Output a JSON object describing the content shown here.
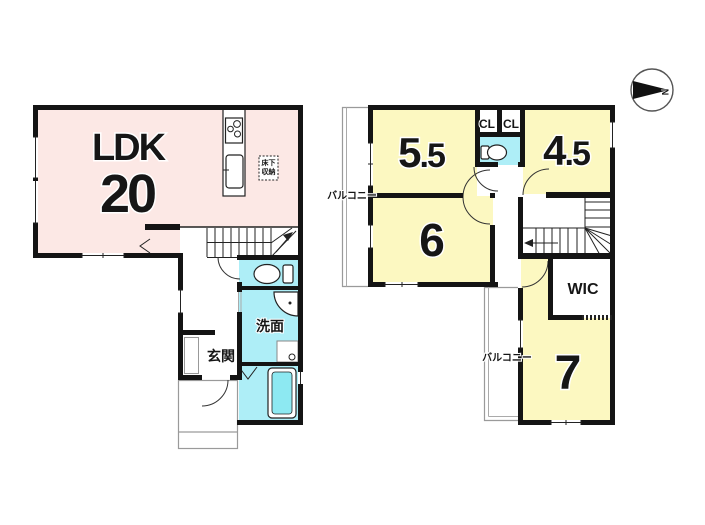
{
  "colors": {
    "wall_color": "#141414",
    "room_pink": "#fce8e5",
    "room_yellow": "#fcf8c1",
    "wet_cyan": "#aeeef7",
    "tub_cyan": "#8de9f2"
  },
  "compass": {
    "north": "N"
  },
  "floor1": {
    "ldk_label": "LDK",
    "ldk_size": "20",
    "washroom_label": "洗面",
    "entrance_label": "玄関",
    "underfloor_storage_line1": "床下",
    "underfloor_storage_line2": "収納"
  },
  "floor2": {
    "room55_main": "5",
    "room55_decimal": ".5",
    "room45_main": "4",
    "room45_decimal": ".5",
    "room6_label": "6",
    "room7_label": "7",
    "wic_label": "WIC",
    "closet1_label": "CL",
    "closet2_label": "CL",
    "balcony_left_label": "バルコニー",
    "balcony_bottom_label": "バルコニー"
  }
}
